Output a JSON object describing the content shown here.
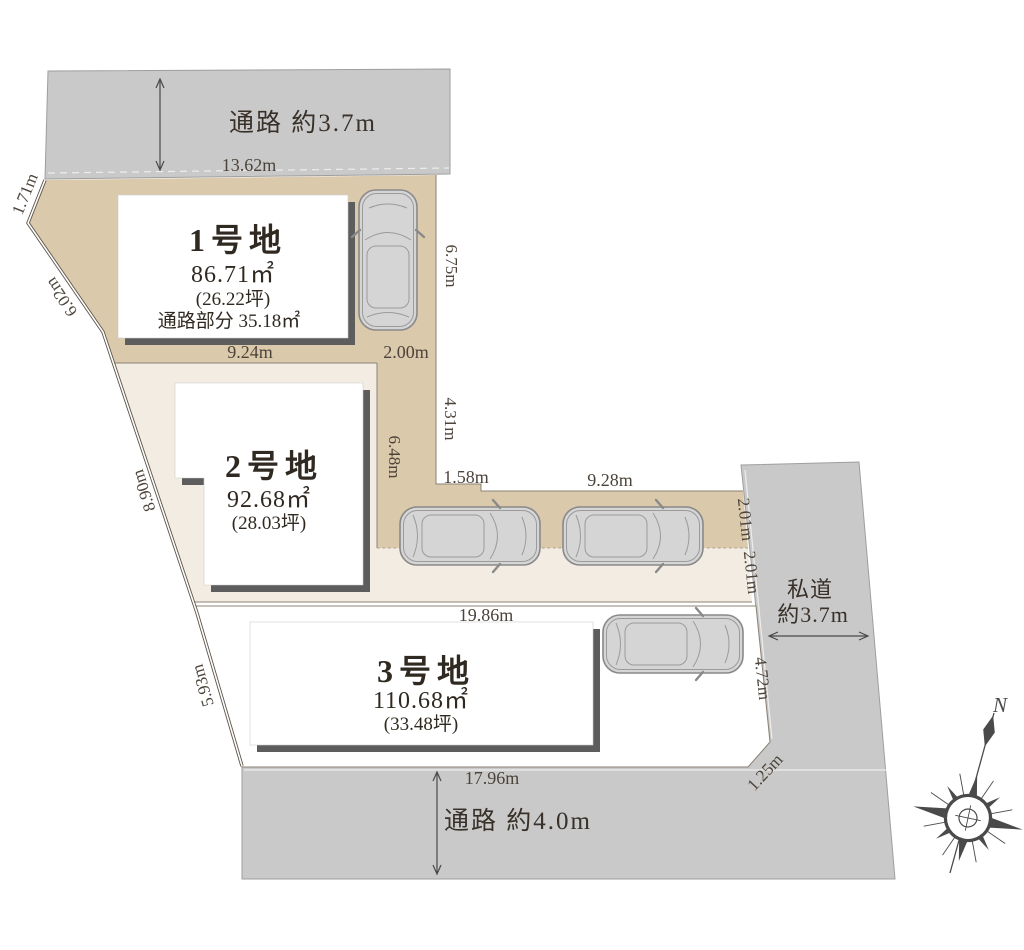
{
  "diagram": {
    "roads": {
      "top_label": "通路 約3.7m",
      "bottom_label": "通路 約4.0m",
      "right_label_1": "私道",
      "right_label_2": "約3.7m"
    },
    "lots": [
      {
        "name": "1号地",
        "area": "86.71㎡",
        "tsubo": "(26.22坪)",
        "note": "通路部分 35.18㎡"
      },
      {
        "name": "2号地",
        "area": "92.68㎡",
        "tsubo": "(28.03坪)"
      },
      {
        "name": "3号地",
        "area": "110.68㎡",
        "tsubo": "(33.48坪)"
      }
    ],
    "dims": {
      "w13_62": "13.62m",
      "w1_71": "1.71m",
      "w6_02": "6.02m",
      "w8_90": "8.90m",
      "w5_93": "5.93m",
      "w9_24": "9.24m",
      "w2_00": "2.00m",
      "w6_75": "6.75m",
      "w4_31": "4.31m",
      "w6_48": "6.48m",
      "w1_58": "1.58m",
      "w9_28": "9.28m",
      "w2_01_a": "2.01m",
      "w2_01_b": "2.01m",
      "w19_86": "19.86m",
      "w4_72": "4.72m",
      "w1_25": "1.25m",
      "w17_96": "17.96m"
    },
    "compass": {
      "north": "N"
    },
    "colors": {
      "road": "#c9c9c9",
      "lot1": "#dbc9ac",
      "lot2": "#f3ece3",
      "lot3": "#ffffff",
      "shadow": "#5d5d5d",
      "line": "#8b8275",
      "text": "#3a3128",
      "car": "#d5d5d5",
      "compass": "#4a4a4a"
    }
  }
}
